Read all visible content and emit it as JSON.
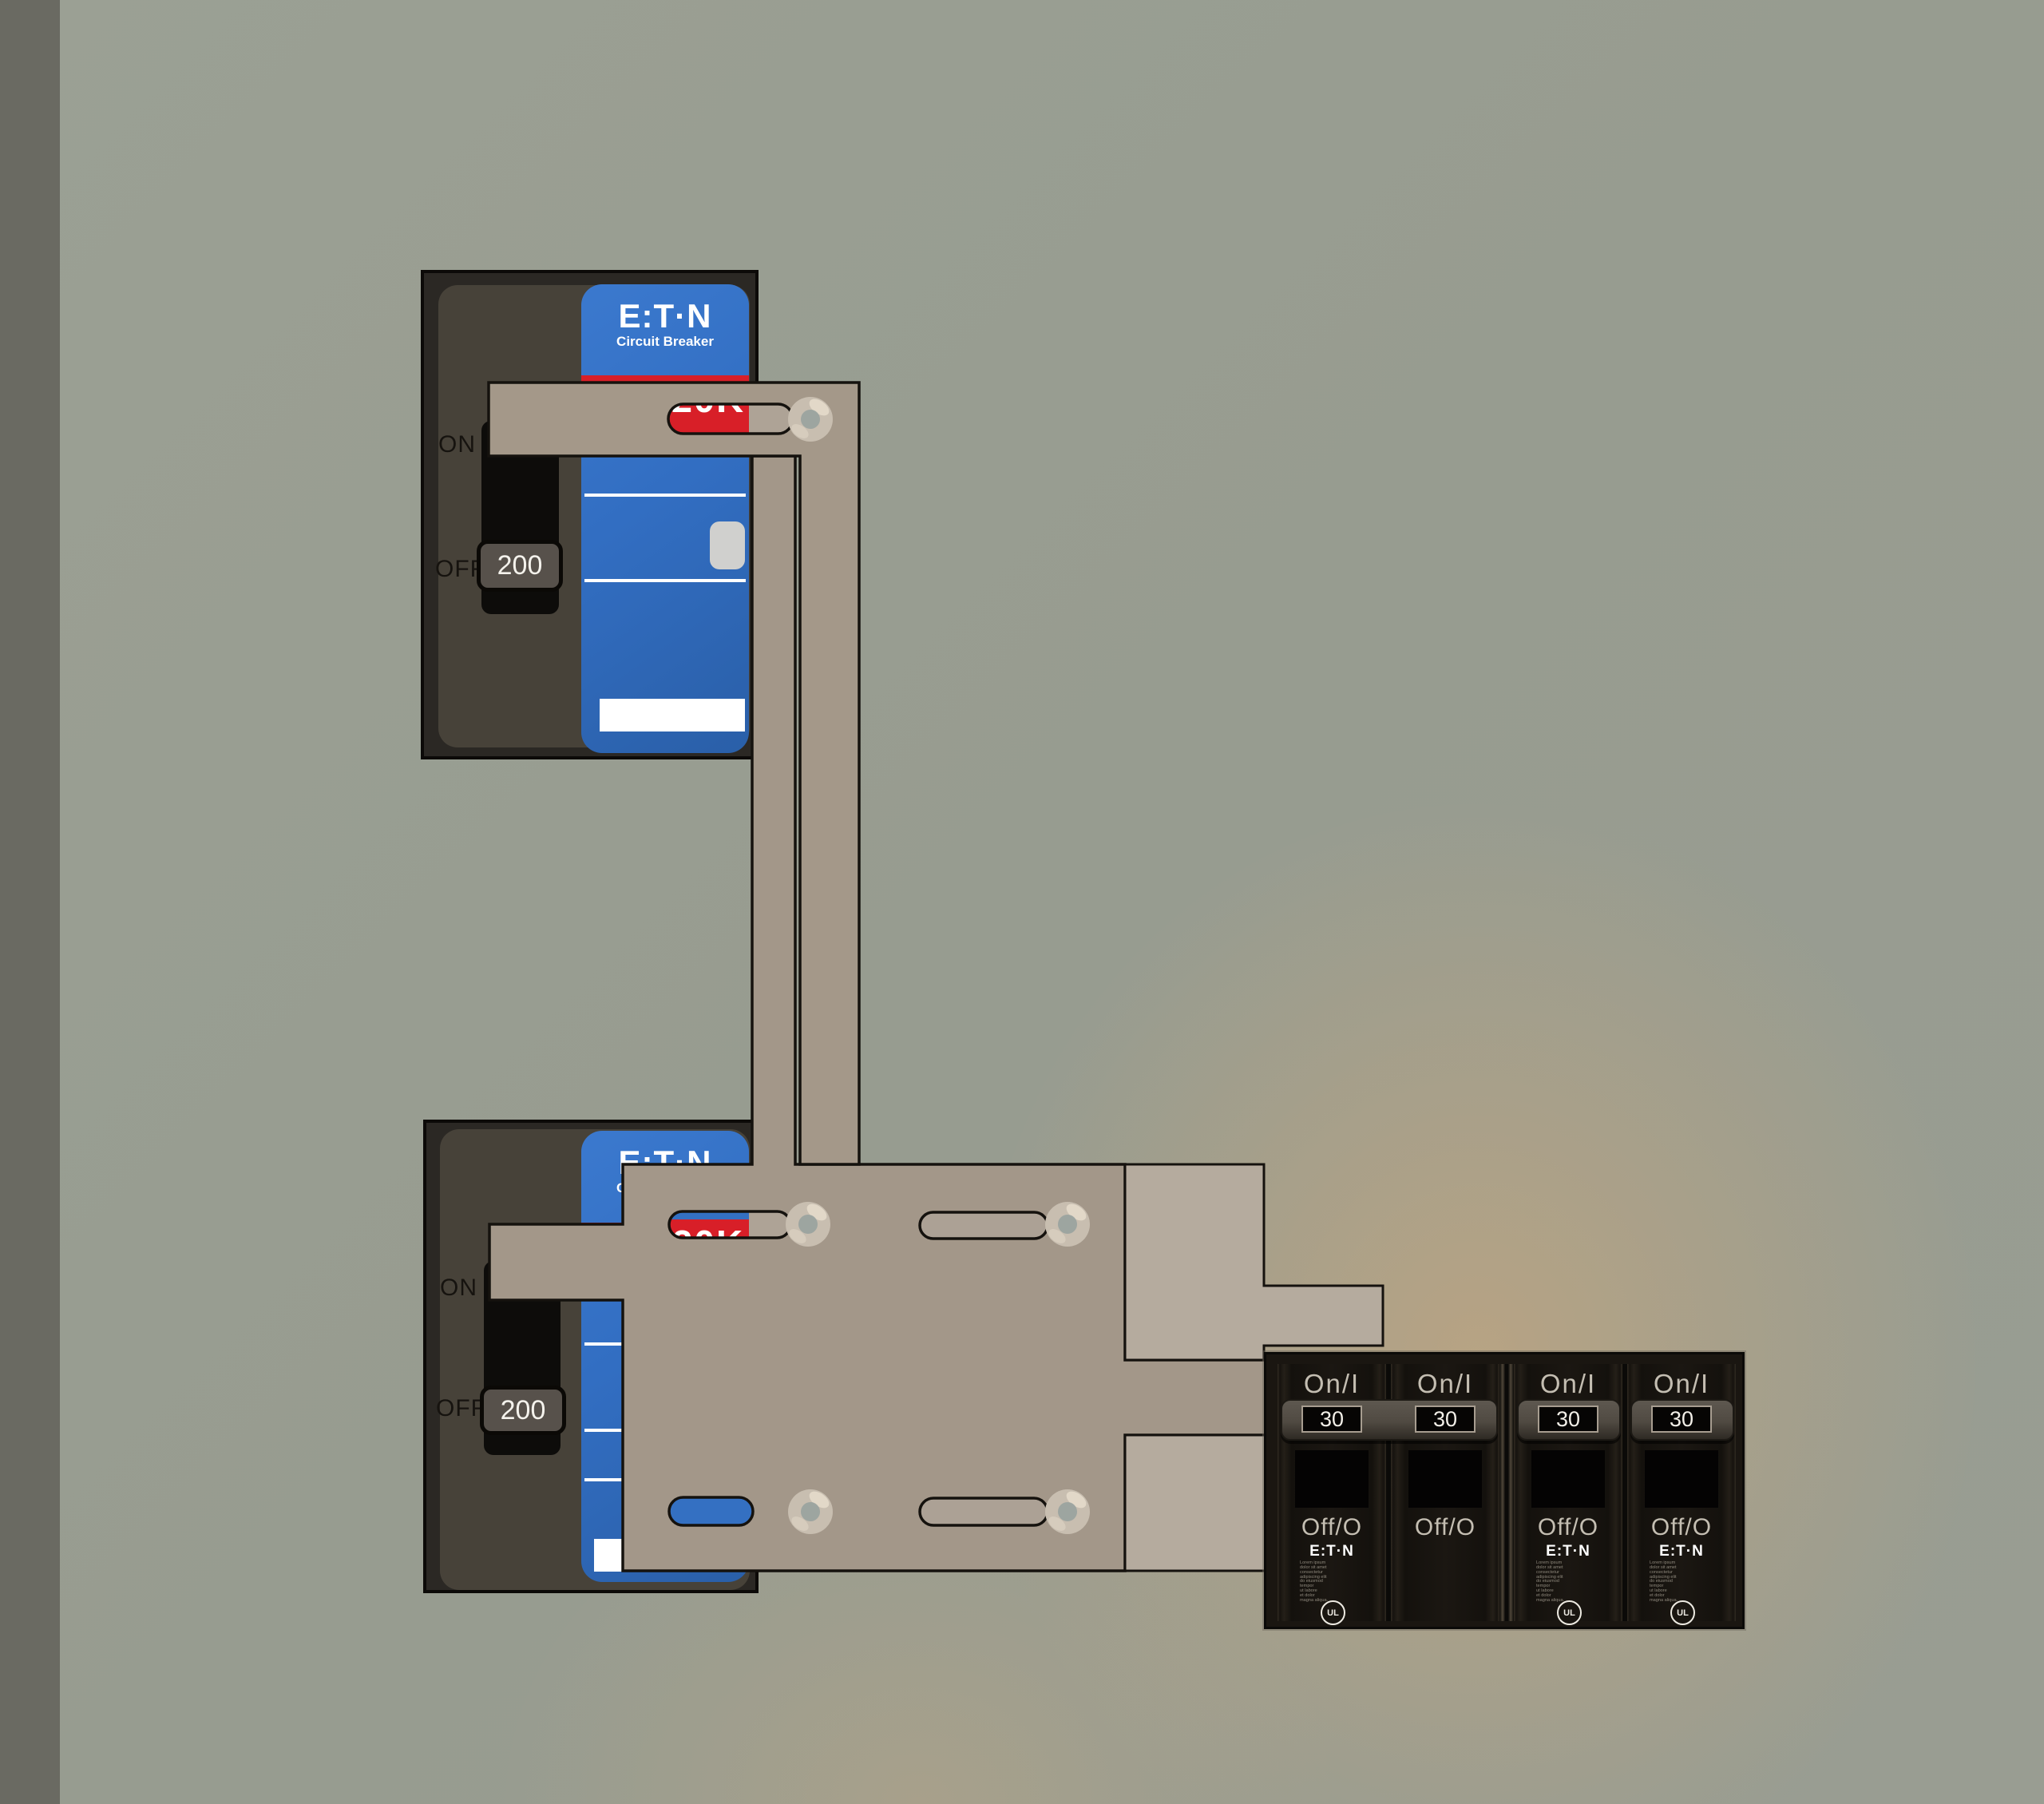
{
  "scene": {
    "description": "Electrical panel interlock simulation",
    "background_color": "#999E92",
    "left_strip_color": "#6A6A62",
    "warm_glow_color": "#D6AA76"
  },
  "breaker_top": {
    "on_label": "ON",
    "off_label": "OFF",
    "handle_amp": "200",
    "handle_state": "off",
    "brand": "E:T·N",
    "brand_sub": "Circuit Breaker",
    "stripe_partial_text": "20K",
    "label_color": "#326EC2",
    "stripe_color": "#D81F28"
  },
  "breaker_bottom": {
    "on_label": "ON",
    "off_label": "OFF",
    "handle_amp": "200",
    "handle_state": "off",
    "brand": "E:T·N",
    "brand_sub": "Circuit Breaker",
    "stripe_partial_text": "20K",
    "label_color": "#326EC2",
    "stripe_color": "#D81F28"
  },
  "interlock": {
    "plate_color": "#A39789",
    "backing_plate_color": "#B5AB9E",
    "screw_color": "#C8BEB0",
    "screw_count": 5
  },
  "module": {
    "poles": [
      {
        "on": "On/I",
        "amp": "30",
        "off": "Off/O",
        "brand": "E:T·N",
        "cert_mark": "UL",
        "label_text": "Lorem ipsum\ndolor sit amet\nconsectetur\nadipiscing elit\ndo eiusmod\ntempor\nut labore\net dolor\nmagna aliqua."
      },
      {
        "on": "On/I",
        "amp": "30",
        "off": "Off/O"
      },
      {
        "on": "On/I",
        "amp": "30",
        "off": "Off/O",
        "brand": "E:T·N",
        "cert_mark": "UL",
        "label_text": "Lorem ipsum\ndolor sit amet\nconsectetur\nadipiscing elit\ndo eiusmod\ntempor\nut labore\net dolor\nmagna aliqua."
      },
      {
        "on": "On/I",
        "amp": "30",
        "off": "Off/O",
        "brand": "E:T·N",
        "cert_mark": "UL",
        "label_text": "Lorem ipsum\ndolor sit amet\nconsectetur\nadipiscing elit\ndo eiusmod\ntempor\nut labore\net dolor\nmagna aliqua."
      }
    ]
  }
}
